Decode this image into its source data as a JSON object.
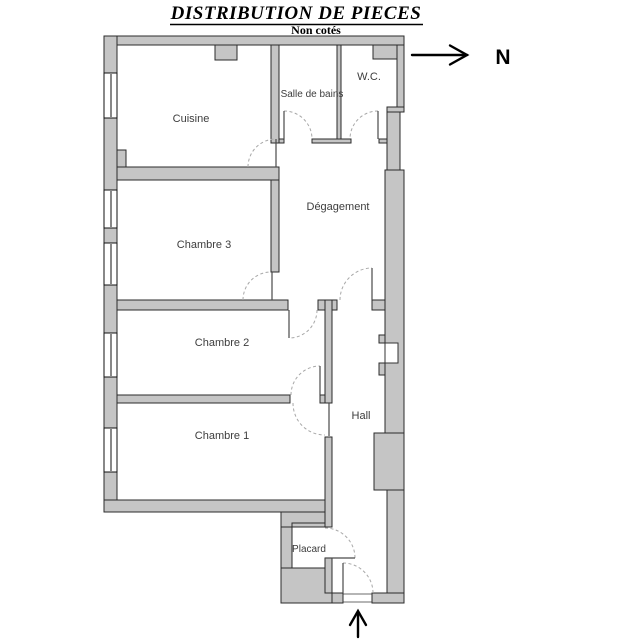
{
  "title": "DISTRIBUTION DE PIECES",
  "subtitle": "Non cotés",
  "compass": {
    "label": "N"
  },
  "rooms": [
    {
      "name": "Cuisine"
    },
    {
      "name": "Salle de bains"
    },
    {
      "name": "W.C."
    },
    {
      "name": "Dégagement"
    },
    {
      "name": "Chambre 3"
    },
    {
      "name": "Chambre 2"
    },
    {
      "name": "Chambre 1"
    },
    {
      "name": "Hall"
    },
    {
      "name": "Placard"
    }
  ],
  "colors": {
    "background": "#ffffff",
    "wall_fill": "#c5c5c5",
    "wall_line": "#2b2b2b",
    "door_arc": "#a8a8a8",
    "label_text": "#3d3d3d"
  }
}
